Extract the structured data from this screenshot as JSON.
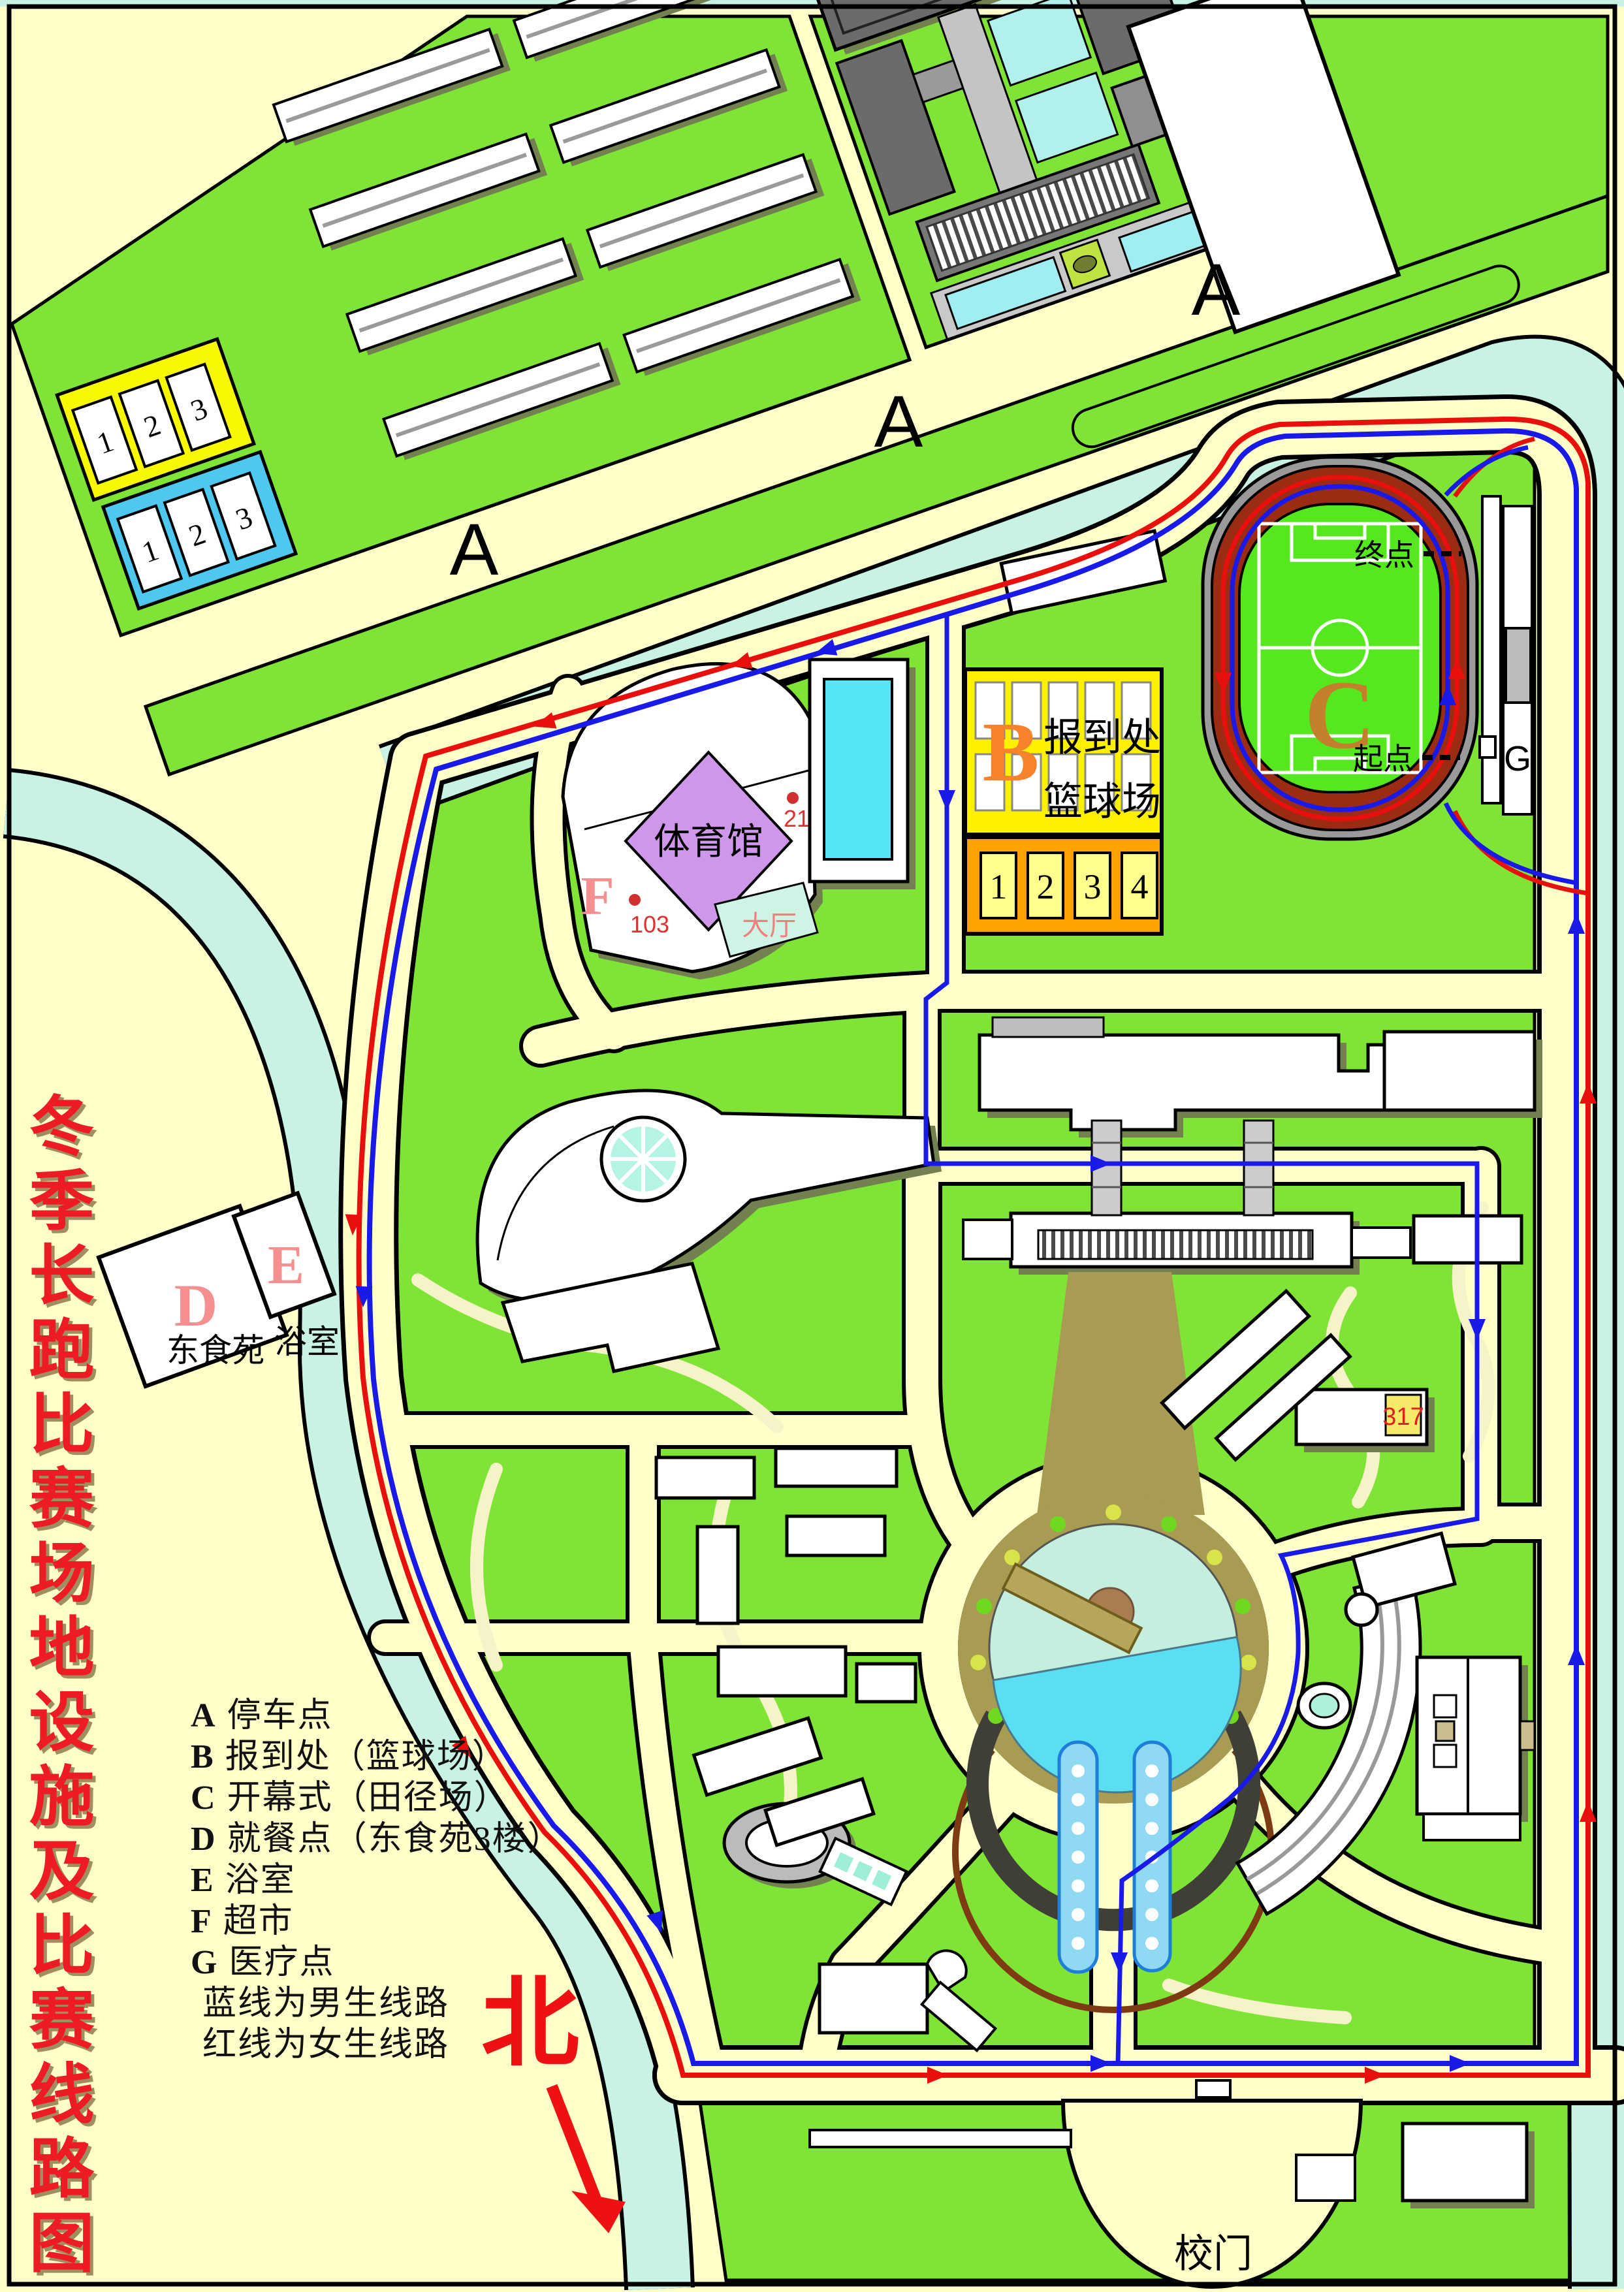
{
  "title": {
    "text": "冬季长跑比赛场地设施及比赛线路图"
  },
  "north": {
    "label": "北"
  },
  "legend": {
    "items": [
      {
        "key": "A",
        "label": "停车点"
      },
      {
        "key": "B",
        "label": "报到处（篮球场）"
      },
      {
        "key": "C",
        "label": "开幕式（田径场）"
      },
      {
        "key": "D",
        "label": "就餐点（东食苑3楼）"
      },
      {
        "key": "E",
        "label": "浴室"
      },
      {
        "key": "F",
        "label": "超市"
      },
      {
        "key": "G",
        "label": "医疗点"
      },
      {
        "key": "",
        "label": "蓝线为男生线路"
      },
      {
        "key": "",
        "label": "红线为女生线路"
      }
    ]
  },
  "map": {
    "parking_labels": [
      "A",
      "A",
      "A"
    ],
    "yellow_stalls": [
      "1",
      "2",
      "3"
    ],
    "blue_stalls": [
      "1",
      "2",
      "3"
    ],
    "stadium": {
      "letter": "C",
      "finish": "终点",
      "start": "起点",
      "medical": "G"
    },
    "basketball": {
      "letter": "B",
      "line1": "报到处",
      "line2": "篮球场",
      "courts": [
        "1",
        "2",
        "3",
        "4"
      ]
    },
    "gym": {
      "letter": "F",
      "name": "体育馆",
      "hall": "大厅",
      "room_a": "103",
      "room_b": "214"
    },
    "dining": {
      "letter": "D",
      "name": "东食苑"
    },
    "bath": {
      "letter": "E",
      "name": "浴室"
    },
    "b317": "317",
    "gate": "校门"
  },
  "colors": {
    "background": "#FFFFC9",
    "field_green": "#80E437",
    "river": "#C8F2E4",
    "track_red": "#9B2B12",
    "infield_green": "#55E81E",
    "route_red": "#E8100C",
    "route_blue": "#1A1AE8",
    "parking_yellow": "#F8F800",
    "parking_blue": "#4FC8F0",
    "court_yellow": "#FFF000",
    "court_orange": "#FFA200",
    "gym_purple": "#CE97E9",
    "plaza_khaki": "#A79C52",
    "title_red": "#ED1C24"
  }
}
